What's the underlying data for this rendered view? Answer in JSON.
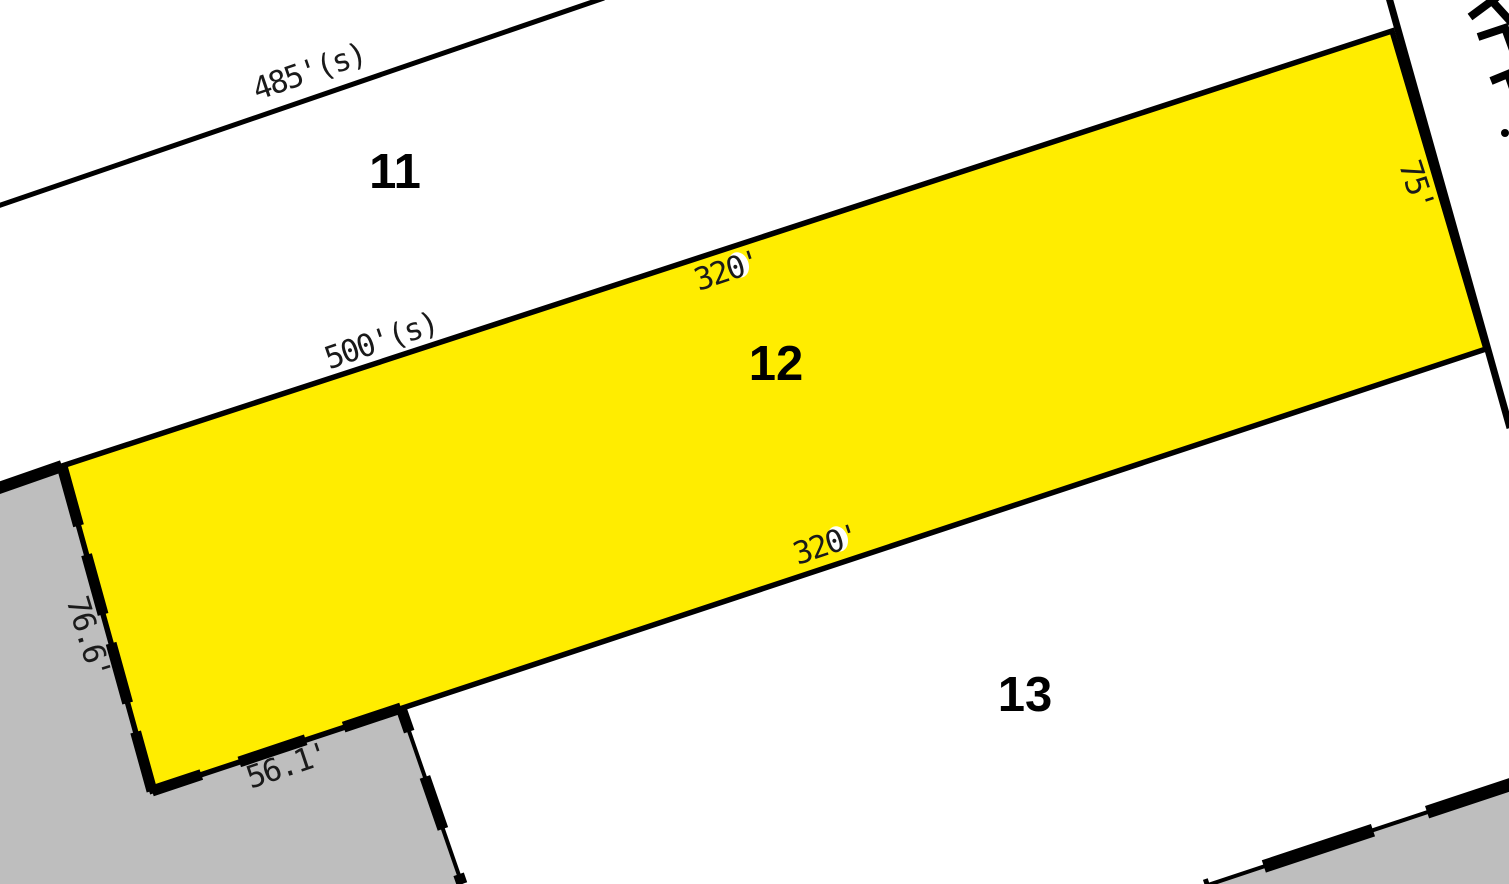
{
  "map_type": "parcel-plat-map",
  "parcels": {
    "lot11": {
      "label": "11"
    },
    "lot12": {
      "label": "12",
      "highlighted": true
    },
    "lot13": {
      "label": "13"
    }
  },
  "dimensions": {
    "north_road": "485'(s)",
    "lot12_north": "500'(s)",
    "lot12_top": "320'",
    "lot12_bottom": "320'",
    "lot12_east": "75'",
    "lot12_west": "76.6'",
    "lot12_southwest": "56.1'"
  },
  "colors": {
    "highlight_yellow": "#FFED00",
    "adjacent_gray": "#BEBEBE",
    "boundary_black": "#000000",
    "background_white": "#FFFFFF"
  }
}
